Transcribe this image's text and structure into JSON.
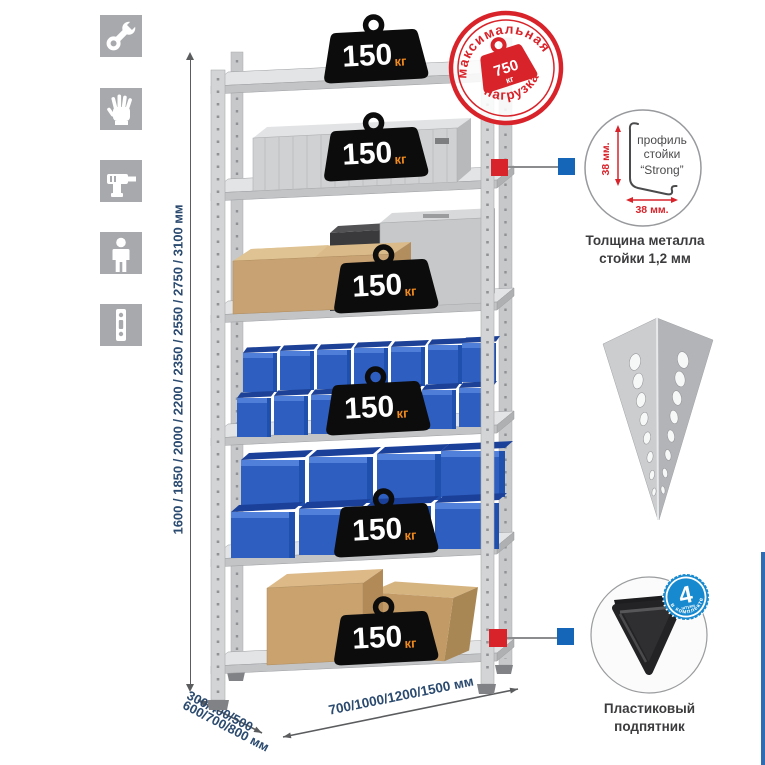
{
  "colors": {
    "accent_red": "#d8232a",
    "accent_blue": "#1565b8",
    "badge_blue": "#1789cf",
    "dim_text_navy": "#2b4a6f",
    "bin_blue": "#2e5fc0",
    "weight_unit_orange": "#f08a1d",
    "icon_tile_gray": "#a7a9ac"
  },
  "sidebar_icons": {
    "items": [
      {
        "name": "wrench"
      },
      {
        "name": "gloves"
      },
      {
        "name": "drill"
      },
      {
        "name": "person"
      },
      {
        "name": "post-profile"
      }
    ]
  },
  "dimensions": {
    "height": "1600 / 1850 / 2000 / 2200 / 2350 / 2550 / 2750 / 3100 мм",
    "depth_line1": "300/400/500",
    "depth_line2": "600/700/800 мм",
    "width": "700/1000/1200/1500 мм"
  },
  "rack": {
    "shelves": 6,
    "shelf_load_value": "150",
    "shelf_load_unit": "кг"
  },
  "max_load_stamp": {
    "arc_top": "максимальная",
    "arc_bottom": "нагрузка",
    "value": "750",
    "unit": "кг"
  },
  "profile_callout": {
    "label_line1": "профиль",
    "label_line2": "стойки",
    "label_line3": "“Strong”",
    "dim_vertical": "38 мм.",
    "dim_horizontal": "38 мм.",
    "caption_line1": "Толщина металла",
    "caption_line2": "стойки 1,2 мм"
  },
  "foot_callout": {
    "badge_value": "4",
    "badge_sub": "штуки",
    "badge_arc": "в комплекте",
    "caption_line1": "Пластиковый",
    "caption_line2": "подпятник"
  }
}
